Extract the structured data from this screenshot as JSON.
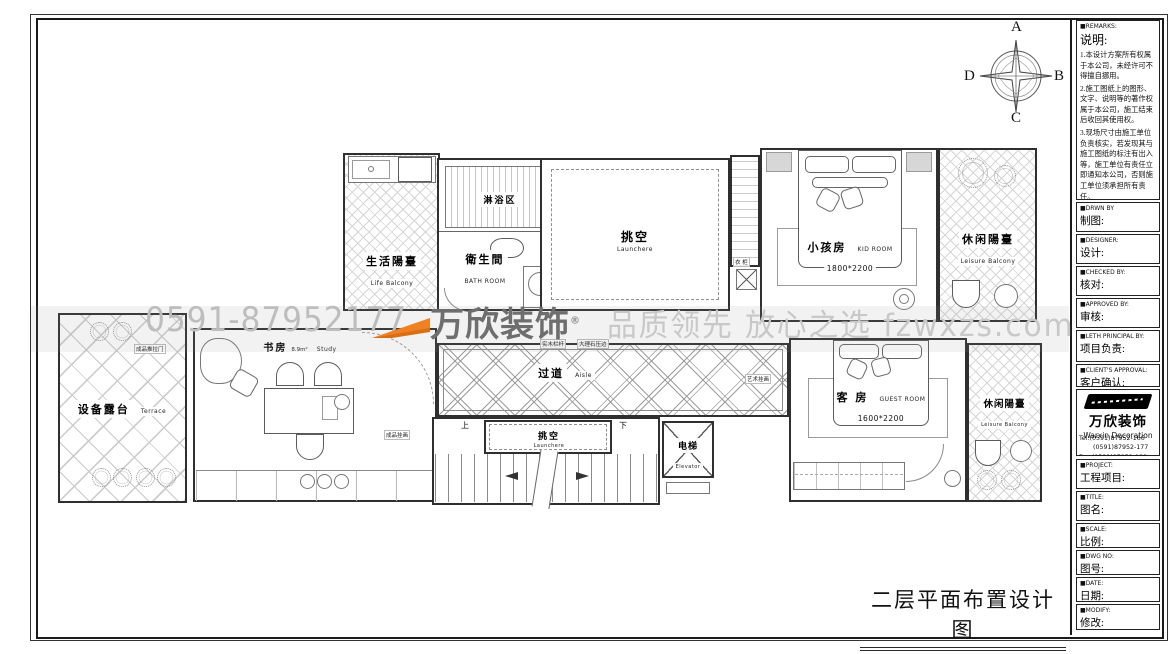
{
  "sheet": {
    "drawing_title": "二层平面布置设计图"
  },
  "compass": {
    "top": "A",
    "right": "B",
    "bottom": "C",
    "left": "D"
  },
  "watermark": {
    "phone": "0591-87952177",
    "brand": "万欣装饰",
    "registered": "®",
    "slogan": "品质领先 放心之选 fzwxzs.com"
  },
  "sidebar": {
    "remarks_en": "■REMARKS:",
    "remarks_cn": "说明:",
    "notes": [
      "1.本设计方案所有权属于本公司，未经许可不得擅自挪用。",
      "2.施工图纸上的图形、文字、说明等的著作权属于本公司，施工结束后收回其使用权。",
      "3.现场尺寸由施工单位负责核实，若发现其与施工图纸的标注有出入等，施工单位有责任立即通知本公司，否则施工单位须承担所有责任。",
      "4.本设计方案是依客户要求设计，经客户签字即视为同意认可，不得随意更改。"
    ],
    "drwn_en": "■DRWN BY",
    "drwn_cn": "制图:",
    "designer_en": "■DESIGNER:",
    "designer_cn": "设计:",
    "checked_en": "■CHECKED BY:",
    "checked_cn": "核对:",
    "approved_en": "■APPROVED BY:",
    "approved_cn": "审核:",
    "principal_en": "■LETH PRINCIPAL BY:",
    "principal_cn": "项目负责:",
    "client_en": "■CLIENT'S APPROVAL:",
    "client_cn": "客户确认:",
    "company": {
      "name_cn": "万欣装饰",
      "name_en": "Warxin Decoration",
      "tel1": "Tel:(0591)87952-166",
      "tel2": "(0591)87952-177",
      "fax": "Fax:(0591)87952-199",
      "web": "Web:WWW.fzwxzs.com"
    },
    "project_en": "■PROJECT:",
    "project_cn": "工程项目:",
    "title_en": "■TITLE:",
    "title_cn": "图名:",
    "scale_en": "■SCALE:",
    "scale_cn": "比例:",
    "dwg_en": "■DWG NO:",
    "dwg_cn": "图号:",
    "date_en": "■DATE:",
    "date_cn": "日期:",
    "modify_en": "■MODIFY:",
    "modify_cn": "修改:"
  },
  "rooms": {
    "life_balcony": {
      "cn": "生活陽臺",
      "en": "Life Balcony"
    },
    "shower": {
      "cn": "淋浴区"
    },
    "bathroom": {
      "cn": "衛生間",
      "en": "BATH ROOM"
    },
    "void_top": {
      "cn": "挑空",
      "en": "Launchere"
    },
    "kid_room": {
      "cn": "小孩房",
      "en": "KID ROOM",
      "dim": "1800*2200"
    },
    "leisure_balcony_top": {
      "cn": "休闲陽臺",
      "en": "Leisure Balcony"
    },
    "terrace": {
      "cn": "设备露台",
      "en": "Terrace"
    },
    "study": {
      "cn": "书房",
      "en": "Study",
      "area": "8.9m²"
    },
    "aisle": {
      "cn": "过道",
      "en": "Aisle"
    },
    "void_bottom": {
      "cn": "挑空",
      "en": "Launchere"
    },
    "elevator": {
      "cn": "电梯",
      "en": "Elevator"
    },
    "guest_room": {
      "cn": "客 房",
      "en": "GUEST ROOM",
      "dim": "1600*2200"
    },
    "leisure_balcony_bottom": {
      "cn": "休闲陽臺",
      "en": "Leisure Balcony"
    }
  },
  "annotations": {
    "wood_rail": "实木栏杆",
    "marble_edge": "大理石压边",
    "art_painting": "艺术挂画",
    "wardrobe": "衣 柜",
    "sliding_door": "成品推拉门",
    "finished_painting": "成品挂画",
    "up": "上",
    "down": "下"
  },
  "colors": {
    "accent_orange": "#ef8122",
    "watermark_gray": "#c8c8c8",
    "line": "#2f2f2f"
  }
}
